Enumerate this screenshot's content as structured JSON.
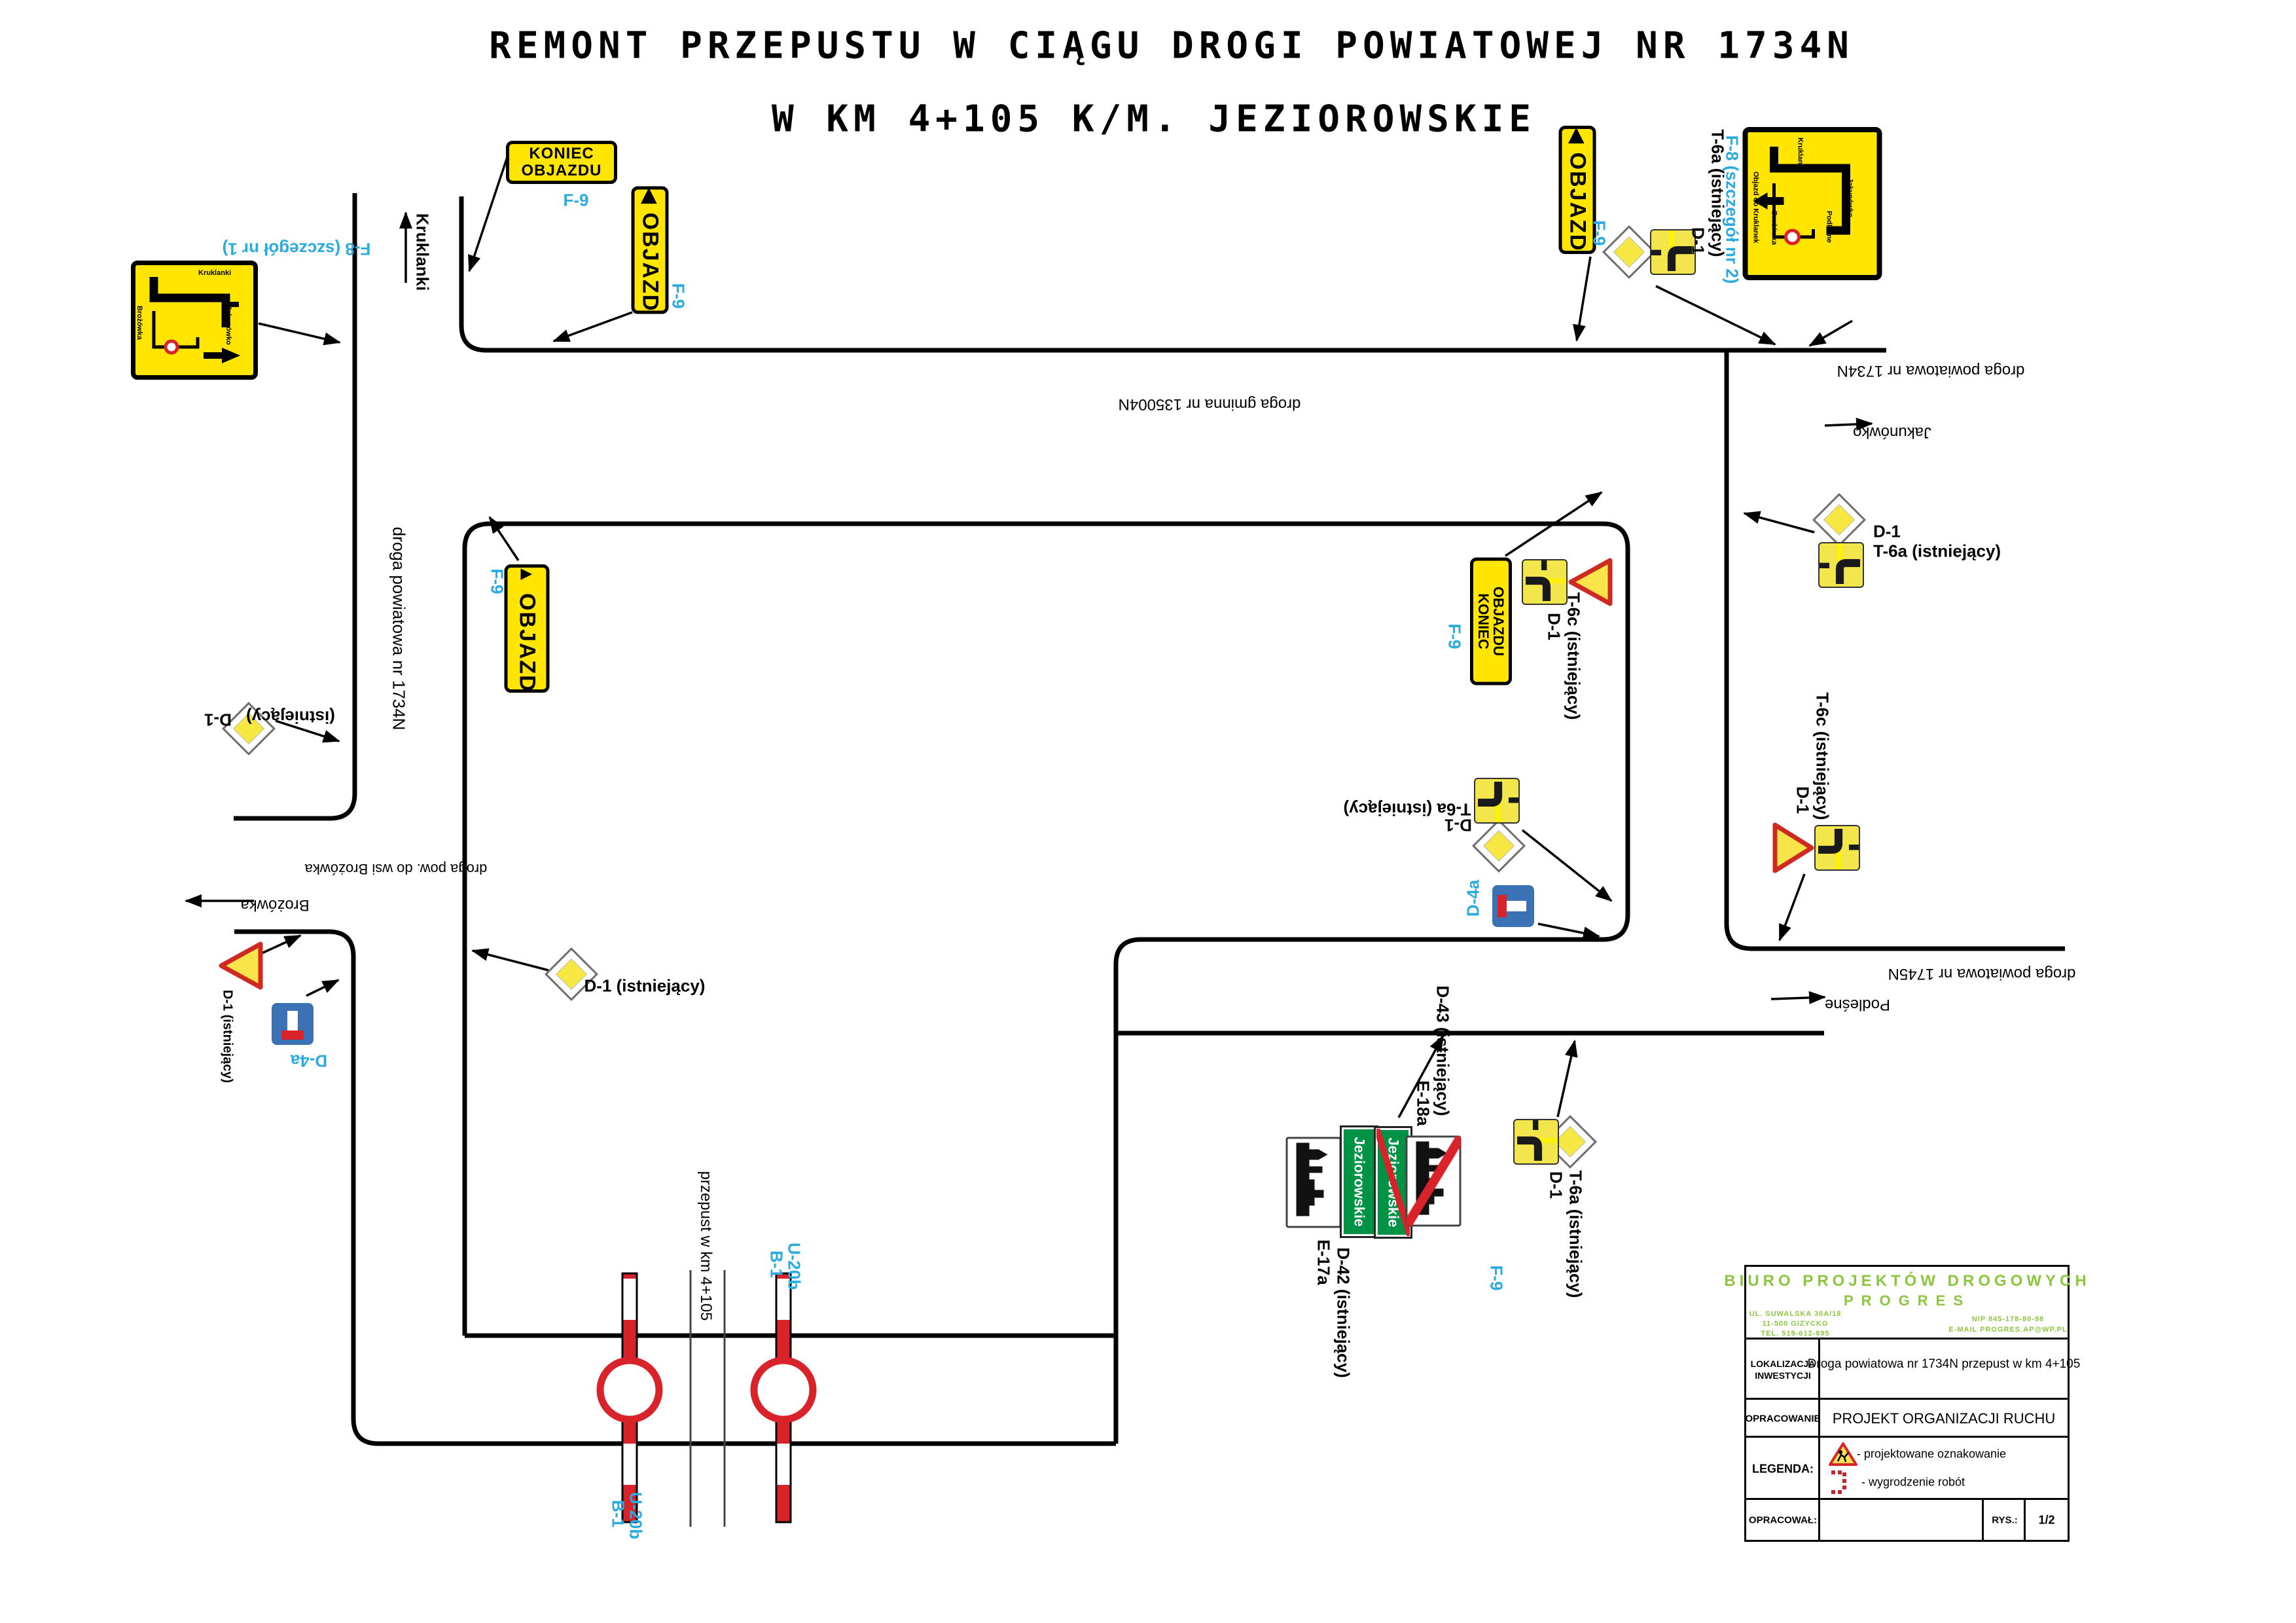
{
  "title": {
    "line1": "REMONT PRZEPUSTU W CIĄGU DROGI POWIATOWEJ NR 1734N",
    "line2": "W KM 4+105 K/M. JEZIOROWSKIE"
  },
  "labels": {
    "objazd": "OBJAZD",
    "koniec": "KONIEC",
    "objazdu": "OBJAZDU",
    "f9": "F-9",
    "f8_detail_1": "F-8 (szczegół nr 1)",
    "f8_detail_2": "F-8 (szczegół nr 2)",
    "d1": "D-1",
    "istniejacy": "(istniejący)",
    "d1_ist": "D-1 (istniejący)",
    "t6a_ist": "T-6a (istniejący)",
    "t6c_ist": "T-6c (istniejący)",
    "d4a": "D-4a",
    "b1": "B-1",
    "u20b": "U-20b",
    "e17a": "E-17a",
    "d42_ist": "D-42 (istniejący)",
    "e18a": "E-18a",
    "d43_ist": "D-43 (istniejący)"
  },
  "roads": {
    "gminna": "droga gminna nr 135004N",
    "pow_1734": "droga powiatowa nr 1734N",
    "pow_1745": "droga powiatowa nr 1745N",
    "pow_brozowka": "droga pow. do wsi Brożówka",
    "przepust": "przepust w km 4+105"
  },
  "places": {
    "kruklanki": "Kruklanki",
    "jakunowko": "Jakunówko",
    "brozowka": "Brożówka",
    "podlesne": "Podleśne",
    "jeziorowskie": "Jeziorowskie"
  },
  "f8_sign": {
    "caption": "Objazd do Kruklanek"
  },
  "icons": {
    "arrow_solid_left": "◀",
    "arrow_solid_up": "▲",
    "arrow_solid_right": "►"
  },
  "title_block": {
    "company_line1": "BIURO PROJEKTÓW DROGOWYCH",
    "company_line2": "PROGRES",
    "address_line1": "UL. SUWALSKA 30A/18",
    "address_line2": "11-500 GIZYCKO",
    "address_line3": "TEL. 519-612-895",
    "nip": "NIP 845-178-80-98",
    "email": "E-MAIL PROGRES.AP@WP.PL",
    "loc_label_line1": "LOKALIZACJA",
    "loc_label_line2": "INWESTYCJI",
    "loc_value": "Droga powiatowa nr 1734N przepust w km 4+105",
    "study_label": "OPRACOWANIE",
    "study_value": "PROJEKT ORGANIZACJI RUCHU",
    "legend_label": "LEGENDA:",
    "legend_item1": "- projektowane oznakowanie",
    "legend_item2": "- wygrodzenie robót",
    "author_label": "OPRACOWAŁ:",
    "drawing_label": "RYS.:",
    "drawing_no": "1/2"
  },
  "colors": {
    "sign_yellow": "#FFE500",
    "plate_yellow": "#F3E64C",
    "diamond_yellow": "#F7E742",
    "cyan": "#29ABE2",
    "green": "#009245",
    "red": "#D8232A",
    "d4a_blue": "#3A72B5",
    "brand_green": "#8CC63F"
  }
}
